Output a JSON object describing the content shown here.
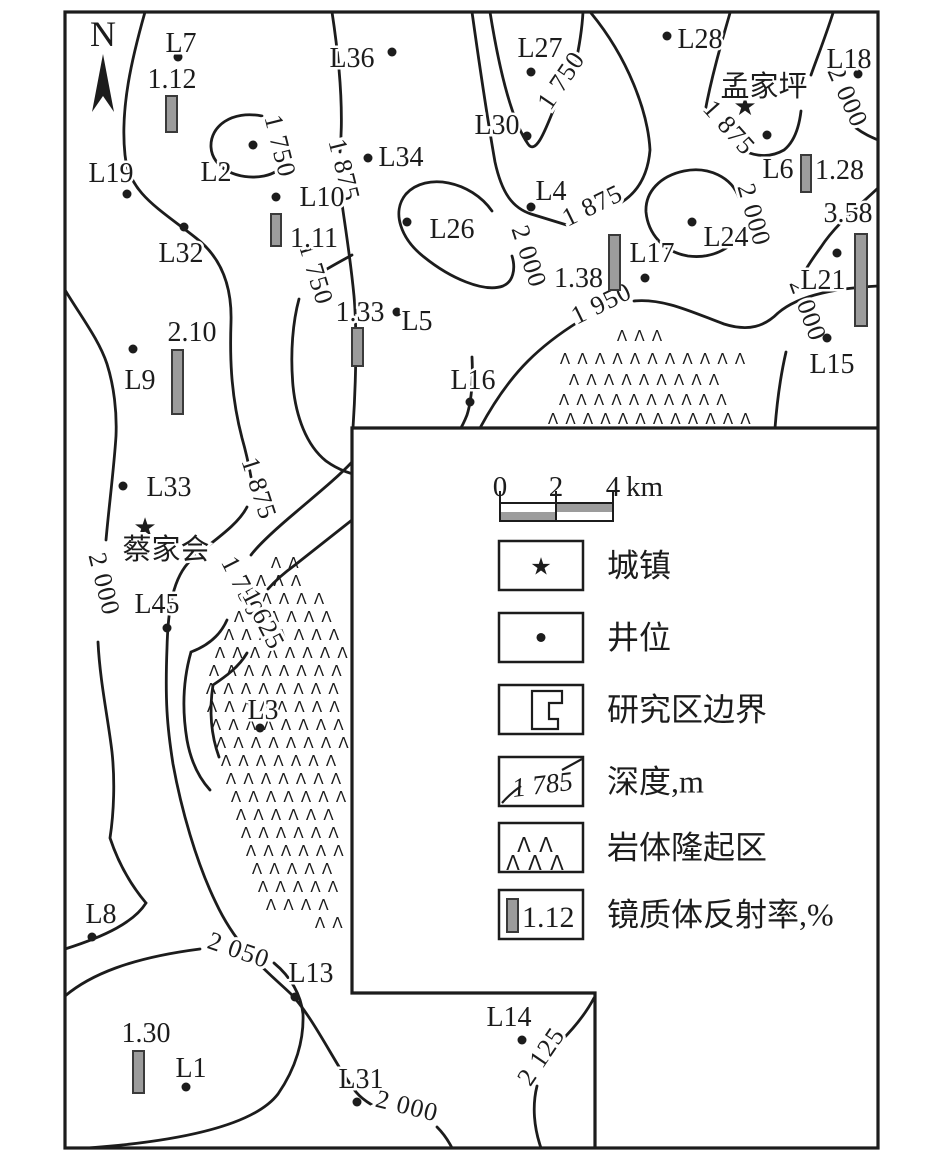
{
  "colors": {
    "ink": "#1c1c1c",
    "bar_fill": "#9c9c9c",
    "bar_stroke": "#3a3a3a",
    "scale_gray": "#9c9c9c",
    "background": "#ffffff"
  },
  "map": {
    "north_label": "N",
    "towns": [
      {
        "name": "孟家坪",
        "star_x": 745,
        "star_y": 107,
        "label_x": 764,
        "label_y": 96
      },
      {
        "name": "蔡家会",
        "star_x": 145,
        "star_y": 528,
        "label_x": 166,
        "label_y": 559
      }
    ],
    "wells": [
      {
        "id": "L7",
        "x": 178,
        "y": 57,
        "lx": 181,
        "ly": 52
      },
      {
        "id": "L36",
        "x": 392,
        "y": 52,
        "lx": 352,
        "ly": 67
      },
      {
        "id": "L27",
        "x": 531,
        "y": 72,
        "lx": 540,
        "ly": 57
      },
      {
        "id": "L28",
        "x": 667,
        "y": 36,
        "lx": 700,
        "ly": 48
      },
      {
        "id": "L18",
        "x": 858,
        "y": 74,
        "lx": 849,
        "ly": 68
      },
      {
        "id": "L19",
        "x": 127,
        "y": 194,
        "lx": 111,
        "ly": 182
      },
      {
        "id": "L2",
        "x": 253,
        "y": 145,
        "lx": 216,
        "ly": 181
      },
      {
        "id": "L34",
        "x": 368,
        "y": 158,
        "lx": 401,
        "ly": 166
      },
      {
        "id": "L30",
        "x": 527,
        "y": 136,
        "lx": 497,
        "ly": 134
      },
      {
        "id": "L10",
        "x": 276,
        "y": 197,
        "lx": 322,
        "ly": 206
      },
      {
        "id": "L32",
        "x": 184,
        "y": 227,
        "lx": 181,
        "ly": 262
      },
      {
        "id": "L26",
        "x": 407,
        "y": 222,
        "lx": 452,
        "ly": 238
      },
      {
        "id": "L4",
        "x": 531,
        "y": 207,
        "lx": 551,
        "ly": 200
      },
      {
        "id": "L6",
        "x": 767,
        "y": 135,
        "lx": 778,
        "ly": 178
      },
      {
        "id": "L17",
        "x": 645,
        "y": 278,
        "lx": 652,
        "ly": 262
      },
      {
        "id": "L24",
        "x": 692,
        "y": 222,
        "lx": 726,
        "ly": 246
      },
      {
        "id": "L21",
        "x": 837,
        "y": 253,
        "lx": 823,
        "ly": 289
      },
      {
        "id": "L15",
        "x": 827,
        "y": 338,
        "lx": 832,
        "ly": 373
      },
      {
        "id": "L5",
        "x": 397,
        "y": 312,
        "lx": 417,
        "ly": 330
      },
      {
        "id": "L16",
        "x": 470,
        "y": 402,
        "lx": 473,
        "ly": 389
      },
      {
        "id": "L9",
        "x": 133,
        "y": 349,
        "lx": 140,
        "ly": 389
      },
      {
        "id": "L33",
        "x": 123,
        "y": 486,
        "lx": 169,
        "ly": 496
      },
      {
        "id": "L45",
        "x": 167,
        "y": 628,
        "lx": 157,
        "ly": 613
      },
      {
        "id": "L3",
        "x": 260,
        "y": 728,
        "lx": 263,
        "ly": 719
      },
      {
        "id": "L8",
        "x": 92,
        "y": 937,
        "lx": 101,
        "ly": 923
      },
      {
        "id": "L13",
        "x": 295,
        "y": 997,
        "lx": 311,
        "ly": 982
      },
      {
        "id": "L1",
        "x": 186,
        "y": 1087,
        "lx": 191,
        "ly": 1077
      },
      {
        "id": "L31",
        "x": 357,
        "y": 1102,
        "lx": 361,
        "ly": 1088
      },
      {
        "id": "L14",
        "x": 522,
        "y": 1040,
        "lx": 509,
        "ly": 1026
      }
    ],
    "vr_bars": [
      {
        "value": "1.12",
        "x": 166,
        "y": 96,
        "w": 11,
        "h": 36,
        "tx": 172,
        "ty": 88,
        "anchor": "middle"
      },
      {
        "value": "1.11",
        "x": 271,
        "y": 214,
        "w": 10,
        "h": 32,
        "tx": 290,
        "ty": 247,
        "anchor": "start"
      },
      {
        "value": "1.33",
        "x": 352,
        "y": 328,
        "w": 11,
        "h": 38,
        "tx": 360,
        "ty": 321,
        "anchor": "middle"
      },
      {
        "value": "2.10",
        "x": 172,
        "y": 350,
        "w": 11,
        "h": 64,
        "tx": 192,
        "ty": 341,
        "anchor": "middle"
      },
      {
        "value": "1.38",
        "x": 609,
        "y": 235,
        "w": 11,
        "h": 55,
        "tx": 603,
        "ty": 287,
        "anchor": "end"
      },
      {
        "value": "1.28",
        "x": 801,
        "y": 155,
        "w": 10,
        "h": 37,
        "tx": 815,
        "ty": 179,
        "anchor": "start"
      },
      {
        "value": "3.58",
        "x": 855,
        "y": 234,
        "w": 12,
        "h": 92,
        "tx": 848,
        "ty": 222,
        "anchor": "middle"
      },
      {
        "value": "1.30",
        "x": 133,
        "y": 1051,
        "w": 11,
        "h": 42,
        "tx": 146,
        "ty": 1042,
        "anchor": "middle"
      }
    ],
    "contour_labels": [
      {
        "v": "1 750",
        "x": 272,
        "y": 148,
        "r": 76
      },
      {
        "v": "1 875",
        "x": 336,
        "y": 172,
        "r": 76
      },
      {
        "v": "1 750",
        "x": 568,
        "y": 85,
        "r": -56
      },
      {
        "v": "1 875",
        "x": 596,
        "y": 213,
        "r": -26
      },
      {
        "v": "1 875",
        "x": 723,
        "y": 133,
        "r": 48
      },
      {
        "v": "2 000",
        "x": 840,
        "y": 100,
        "r": 66
      },
      {
        "v": "2 000",
        "x": 746,
        "y": 217,
        "r": 74
      },
      {
        "v": "2 000",
        "x": 521,
        "y": 259,
        "r": 72
      },
      {
        "v": "1 875",
        "x": 251,
        "y": 491,
        "r": 72
      },
      {
        "v": "1 750",
        "x": 308,
        "y": 276,
        "r": 73
      },
      {
        "v": "1 950",
        "x": 605,
        "y": 311,
        "r": -26
      },
      {
        "v": "2 000",
        "x": 800,
        "y": 313,
        "r": 70
      },
      {
        "v": "2 000",
        "x": 96,
        "y": 586,
        "r": 76
      },
      {
        "v": "1 750",
        "x": 235,
        "y": 590,
        "r": 63
      },
      {
        "v": "1 625",
        "x": 256,
        "y": 623,
        "r": 63
      },
      {
        "v": "2 050",
        "x": 236,
        "y": 958,
        "r": 19
      },
      {
        "v": "2 000",
        "x": 405,
        "y": 1114,
        "r": 14
      },
      {
        "v": "2 125",
        "x": 548,
        "y": 1061,
        "r": -56
      }
    ],
    "contour_paths": [
      "M145,12 C132,58 120,108 125,155 C129,193 158,208 196,238 C222,258 232,288 231,322 C230,352 230,392 242,438 C246,452 249,466 251,477",
      "M247,507 C237,527 208,544 191,560 C173,577 168,608 167,648 C165,700 167,726 173,764 C181,808 196,862 216,903 C238,950 268,972 291,994 C314,1018 338,1070 356,1092 C361,1098 367,1102 372,1105",
      "M437,1127 C443,1133 448,1140 452,1148",
      "M262,116 C232,110 210,126 211,147 C212,168 238,181 264,176 C274,174 281,169 285,162",
      "M332,12 C339,58 344,108 340,152",
      "M341,196 C344,220 350,254 354,296 C357,330 356,382 353,428",
      "M490,12 C498,62 510,118 528,144 C537,157 548,122 556,104",
      "M575,66 C579,48 582,30 583,12",
      "M472,12 C479,62 488,122 495,162 C502,194 513,208 531,214 C544,218 557,222 570,226",
      "M622,202 C639,191 648,174 650,150 C648,112 628,58 591,13",
      "M730,13 C721,44 711,79 705,112",
      "M744,151 C758,157 772,157 784,150 C794,142 799,128 801,111",
      "M833,13 C825,38 817,58 811,75",
      "M856,128 C864,134 871,137 878,140",
      "M739,198 C732,177 708,166 684,171 C660,176 645,192 646,212 C648,233 663,252 688,256 C711,259 731,249 738,235",
      "M492,211 C471,181 426,172 406,194 C391,212 401,239 424,257 C450,278 484,293 503,286 C513,282 516,269 512,256",
      "M878,188 C858,207 836,224 821,247 C813,258 808,265 804,273",
      "M786,352 C780,378 777,402 775,428",
      "M480,428 C493,404 510,379 528,361 C545,344 562,332 578,322",
      "M634,301 C664,298 694,313 724,324 C749,332 765,326 778,313 C800,294 840,288 878,286",
      "M352,255 C341,261 330,267 322,272",
      "M299,299 C293,321 290,352 293,386 C296,416 306,445 326,461 C351,479 381,481 410,471 C440,461 458,438 467,415 C472,399 473,378 472,357",
      "M65,290 C82,318 99,340 107,364 C114,386 117,412 116,436 C114,468 109,506 106,540",
      "M98,642 C100,682 108,718 112,752 C115,780 114,812 110,838 C118,862 130,884 146,903 C134,922 106,936 65,949",
      "M352,462 C337,478 317,494 296,512 C277,528 260,543 251,555",
      "M227,620 C220,636 207,646 191,652 C183,680 182,710 187,740 C191,762 199,778 210,790",
      "M352,520 C334,534 315,549 295,565 C284,573 275,581 268,589",
      "M247,653 C239,667 225,677 213,685 C209,711 211,735 219,757",
      "M65,996 C90,975 130,958 200,949",
      "M274,963 C291,977 301,995 303,1014 C304,1040 296,1068 278,1094 C252,1128 170,1142 88,1148",
      "M594,998 C585,1015 573,1029 561,1041",
      "M537,1086 C532,1106 534,1128 541,1148"
    ],
    "uplift_rows_left": [
      [
        568,
        276,
        296
      ],
      [
        586,
        261,
        312
      ],
      [
        604,
        249,
        322
      ],
      [
        622,
        239,
        332
      ],
      [
        640,
        229,
        340
      ],
      [
        658,
        220,
        346
      ],
      [
        676,
        214,
        348
      ],
      [
        694,
        211,
        349
      ],
      [
        712,
        212,
        349
      ],
      [
        730,
        216,
        349
      ],
      [
        748,
        221,
        348
      ],
      [
        766,
        226,
        347
      ],
      [
        784,
        231,
        346
      ],
      [
        802,
        236,
        345
      ],
      [
        820,
        241,
        344
      ],
      [
        838,
        246,
        343
      ],
      [
        856,
        251,
        342
      ],
      [
        874,
        257,
        341
      ],
      [
        892,
        263,
        340
      ],
      [
        910,
        271,
        338
      ],
      [
        928,
        320,
        339
      ]
    ],
    "uplift_rows_right": [
      [
        341,
        622,
        660
      ],
      [
        364,
        565,
        740
      ],
      [
        385,
        574,
        727
      ],
      [
        405,
        564,
        736
      ],
      [
        424,
        553,
        748
      ]
    ]
  },
  "legend": {
    "scale": {
      "labels": [
        "0",
        "2",
        "4"
      ],
      "unit": "km"
    },
    "items": [
      {
        "type": "star",
        "label": "城镇"
      },
      {
        "type": "dot",
        "label": "井位"
      },
      {
        "type": "boundary",
        "label": "研究区边界"
      },
      {
        "type": "contour",
        "sample": "1 785",
        "label": "深度,m"
      },
      {
        "type": "uplift",
        "label": "岩体隆起区"
      },
      {
        "type": "vr",
        "sample": "1.12",
        "label": "镜质体反射率,%"
      }
    ]
  }
}
